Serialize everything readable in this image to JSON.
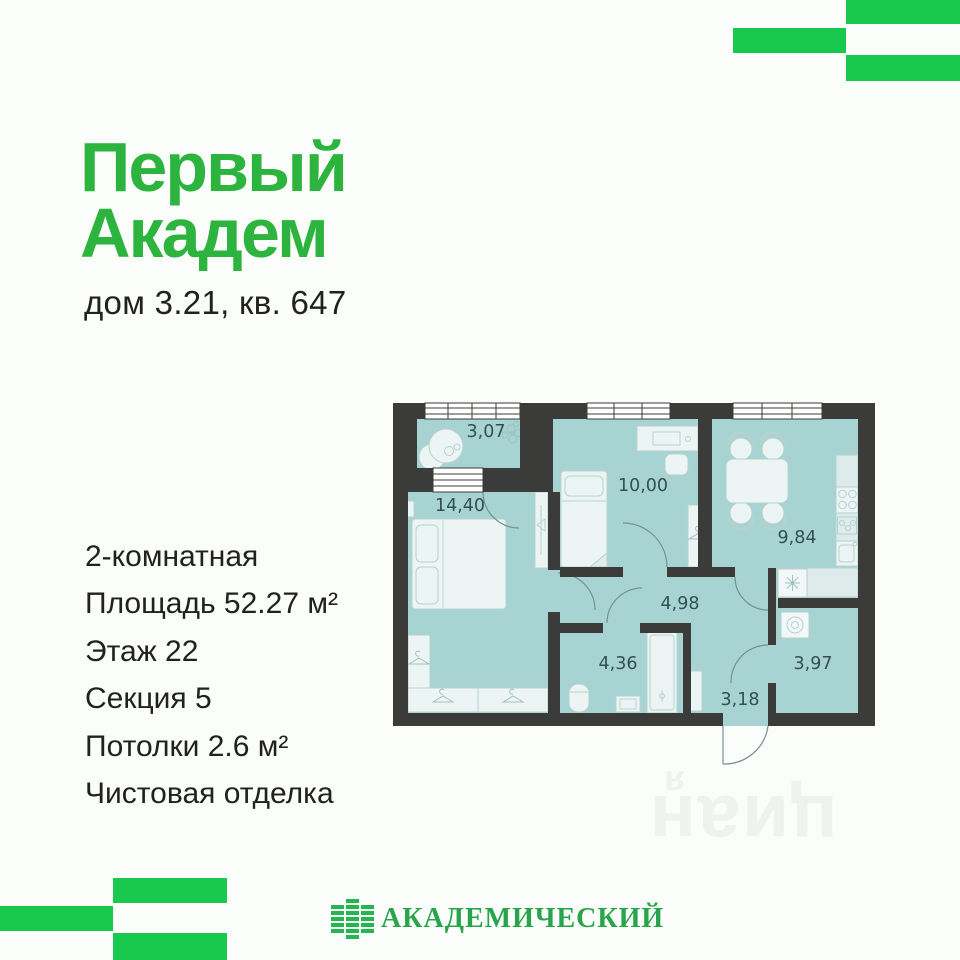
{
  "colors": {
    "brand_green": "#18c94d",
    "title_green": "#2db43e",
    "logo_green": "#28a44b",
    "plan_floor": "#a7d4d2",
    "plan_wall": "#3b3b39"
  },
  "header": {
    "title_line1": "Первый",
    "title_line2": "Академ",
    "subtitle": "дом 3.21, кв. 647"
  },
  "details": {
    "items": [
      "2-комнатная",
      "Площадь 52.27 м²",
      "Этаж 22",
      "Секция 5",
      "Потолки 2.6 м²",
      "Чистовая отделка"
    ]
  },
  "floor_plan": {
    "rooms": [
      {
        "name": "balcony",
        "area": "3,07"
      },
      {
        "name": "bedroom",
        "area": "14,40"
      },
      {
        "name": "bedroom-2",
        "area": "10,00"
      },
      {
        "name": "kitchen",
        "area": "9,84"
      },
      {
        "name": "hallway",
        "area": "4,98"
      },
      {
        "name": "bathroom",
        "area": "4,36"
      },
      {
        "name": "storage",
        "area": "3,97"
      },
      {
        "name": "entry",
        "area": "3,18"
      }
    ]
  },
  "watermark": {
    "letter": "я",
    "text": "циан"
  },
  "footer": {
    "logo_text": "АКАДЕМИЧЕСКИЙ"
  }
}
